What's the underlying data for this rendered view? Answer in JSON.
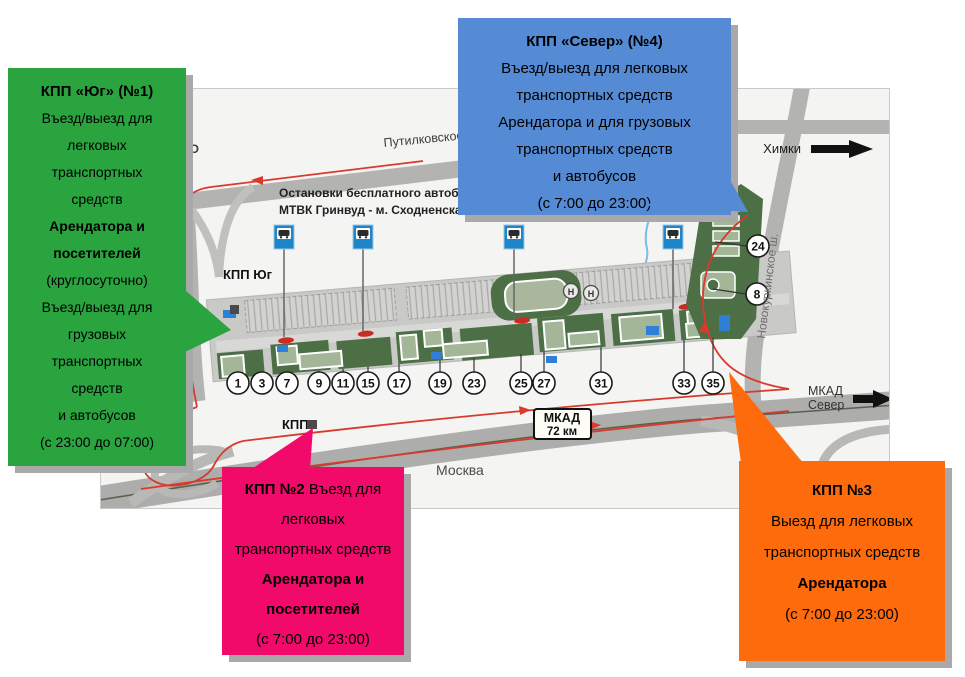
{
  "callouts": {
    "kpp_yug": {
      "color": "#2aa43f",
      "lines": [
        [
          {
            "t": "КПП «Юг» (№1)",
            "b": true
          }
        ],
        [
          {
            "t": "Въезд/выезд для"
          }
        ],
        [
          {
            "t": "легковых"
          }
        ],
        [
          {
            "t": "транспортных"
          }
        ],
        [
          {
            "t": "средств"
          }
        ],
        [
          {
            "t": "Арендатора и",
            "b": true
          }
        ],
        [
          {
            "t": "посетителей",
            "b": true
          }
        ],
        [
          {
            "t": "(круглосуточно)"
          }
        ],
        [
          {
            "t": "Въезд/выезд  для"
          }
        ],
        [
          {
            "t": "грузовых"
          }
        ],
        [
          {
            "t": "транспортных"
          }
        ],
        [
          {
            "t": "средств"
          }
        ],
        [
          {
            "t": "и автобусов"
          }
        ],
        [
          {
            "t": "(с 23:00 до 07:00)"
          }
        ]
      ]
    },
    "kpp_sever": {
      "color": "#548bd4",
      "lines": [
        [
          {
            "t": "КПП «Север» (№4)",
            "b": true
          }
        ],
        [
          {
            "t": "Въезд/выезд  для легковых"
          }
        ],
        [
          {
            "t": "транспортных средств"
          }
        ],
        [
          {
            "t": "Арендатора и для грузовых"
          }
        ],
        [
          {
            "t": "транспортных средств"
          }
        ],
        [
          {
            "t": "и автобусов"
          }
        ],
        [
          {
            "t": "(с 7:00 до 23:00)"
          }
        ]
      ]
    },
    "kpp_2": {
      "color": "#f20a6b",
      "lines": [
        [
          {
            "t": "КПП №2 ",
            "b": true
          },
          {
            "t": "Въезд для"
          }
        ],
        [
          {
            "t": "легковых"
          }
        ],
        [
          {
            "t": "транспортных средств"
          }
        ],
        [
          {
            "t": "Арендатора и",
            "b": true
          }
        ],
        [
          {
            "t": "посетителей",
            "b": true
          }
        ],
        [
          {
            "t": "(с 7:00 до 23:00)"
          }
        ]
      ]
    },
    "kpp_3": {
      "color": "#fd6b0d",
      "lines": [
        [
          {
            "t": "КПП №3",
            "b": true
          }
        ],
        [
          {
            "t": "Выезд для легковых"
          }
        ],
        [
          {
            "t": "транспортных средств"
          }
        ],
        [
          {
            "t": "Арендатора",
            "b": true
          }
        ],
        [
          {
            "t": "(с 7:00 до 23:00)"
          }
        ]
      ]
    }
  },
  "map": {
    "labels": {
      "kpp_yug_marker": "КПП Юг",
      "kpp_marker": "КПП",
      "bus_note_line1": "Остановки бесплатного автобуса",
      "bus_note_line2": "МТВК Гринвуд - м. Сходненская",
      "road_putilkovskoe": "Путилковское",
      "road_novokurkinskoe": "Новокуркинское ш.",
      "khimki": "Химки",
      "mkad_sever_line1": "МКАД",
      "mkad_sever_line2": "Север",
      "mkad_sign_line1": "МКАД",
      "mkad_sign_line2": "72 км",
      "moscow": "Москва",
      "partial_left": "НО",
      "helipad": "Н"
    },
    "building_numbers": [
      "1",
      "3",
      "7",
      "9",
      "11",
      "15",
      "17",
      "19",
      "23",
      "25",
      "27",
      "31",
      "33",
      "35"
    ],
    "side_numbers": [
      "24",
      "8"
    ],
    "bus_stop_count": 4
  },
  "colors": {
    "map_bg": "#f4f4f3",
    "road": "#b3b3b2",
    "mkad": "#adadac",
    "route_red": "#d93a2c",
    "bus_sign_blue": "#1e86c8",
    "green_dark": "#4d6f45",
    "building_light": "#a3b698",
    "shadow": "#a9a9a9"
  }
}
